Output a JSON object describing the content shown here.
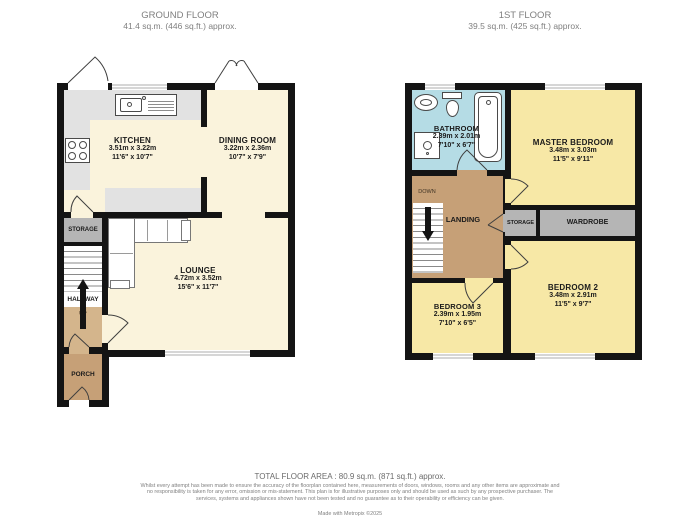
{
  "colors": {
    "wall": "#141414",
    "cream": "#FAF3DC",
    "yellow": "#F7E8A6",
    "blue": "#B5DCE5",
    "tan": "#C6A077",
    "tan_light": "#D4B58C",
    "gray_room": "#B5B5B5",
    "counter": "#E2E2E2",
    "window_line": "#ACACAC",
    "fixture_line": "#4A4A4A",
    "label": "#1B1B1B"
  },
  "ground_floor": {
    "title": "GROUND FLOOR",
    "subtitle": "41.4 sq.m. (446 sq.ft.) approx.",
    "rooms": {
      "kitchen": {
        "name": "KITCHEN",
        "metric": "3.51m x 3.22m",
        "imperial": "11'6\" x 10'7\""
      },
      "dining": {
        "name": "DINING ROOM",
        "metric": "3.22m x 2.36m",
        "imperial": "10'7\" x 7'9\""
      },
      "lounge": {
        "name": "LOUNGE",
        "metric": "4.72m x 3.52m",
        "imperial": "15'6\" x 11'7\""
      },
      "storage": {
        "name": "STORAGE"
      },
      "hallway": {
        "name": "HALLWAY"
      },
      "porch": {
        "name": "PORCH"
      },
      "stairs": {
        "label": "UP"
      }
    }
  },
  "first_floor": {
    "title": "1ST FLOOR",
    "subtitle": "39.5 sq.m. (425 sq.ft.) approx.",
    "rooms": {
      "bathroom": {
        "name": "BATHROOM",
        "metric": "2.39m x 2.01m",
        "imperial": "7'10\" x 6'7\""
      },
      "master": {
        "name": "MASTER BEDROOM",
        "metric": "3.48m x 3.03m",
        "imperial": "11'5\" x 9'11\""
      },
      "bedroom2": {
        "name": "BEDROOM 2",
        "metric": "3.48m x 2.91m",
        "imperial": "11'5\" x 9'7\""
      },
      "bedroom3": {
        "name": "BEDROOM 3",
        "metric": "2.39m x 1.95m",
        "imperial": "7'10\" x 6'5\""
      },
      "landing": {
        "name": "LANDING"
      },
      "storage": {
        "name": "STORAGE"
      },
      "wardrobe": {
        "name": "WARDROBE"
      },
      "stairs": {
        "label": "DOWN"
      }
    }
  },
  "footer": {
    "total": "TOTAL FLOOR AREA : 80.9 sq.m. (871 sq.ft.) approx.",
    "disclaimer": "Whilst every attempt has been made to ensure the accuracy of the floorplan contained here, measurements of doors, windows, rooms and any other items are approximate and no responsibility is taken for any error, omission or mis-statement. This plan is for illustrative purposes only and should be used as such by any prospective purchaser. The services, systems and appliances shown have not been tested and no guarantee as to their operability or efficiency can be given.",
    "credit": "Made with Metropix ©2025"
  }
}
